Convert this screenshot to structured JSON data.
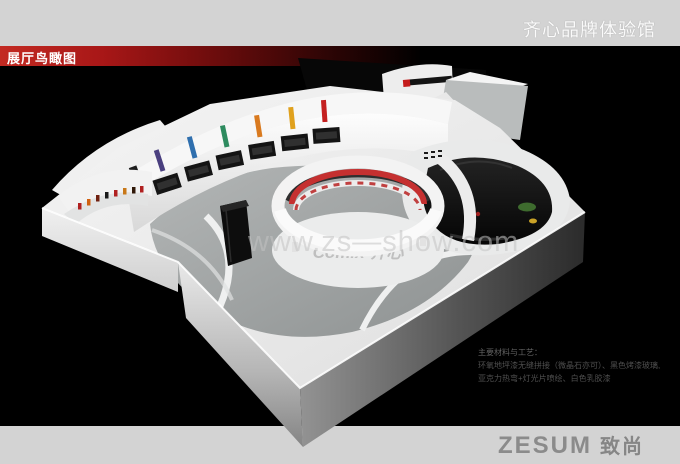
{
  "header": {
    "title": "齐心品牌体验馆"
  },
  "section_bar": {
    "label": "展厅鸟瞰图"
  },
  "watermark": {
    "text": "www.zs—show.com"
  },
  "materials": {
    "heading": "主要材料与工艺：",
    "line1": "环氧地坪漆无缝拼接（微晶石亦可）、黑色烤漆玻璃,",
    "line2": "亚克力热弯+灯光片喷绘、白色乳胶漆"
  },
  "footer": {
    "brand_latin": "ZESUM",
    "brand_cn": "致尚"
  },
  "model": {
    "floor_logo": "Comix 齐心",
    "strip_colors": [
      "#4a3f7f",
      "#2f6fae",
      "#2e8b5f",
      "#d97a1f",
      "#e0a11d",
      "#c42020"
    ],
    "banner_color": "#c53030"
  },
  "colors": {
    "band_gray": "#d3d3d3",
    "bar_red": "#b71c1c",
    "background": "#000000",
    "logo_gray": "#8b8b8b"
  }
}
